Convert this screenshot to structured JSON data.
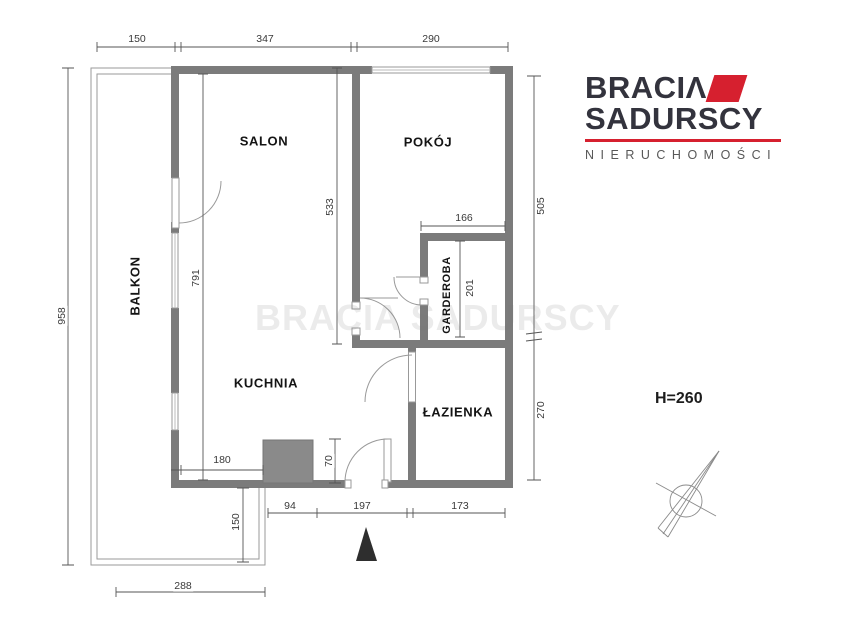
{
  "canvas": {
    "width": 860,
    "height": 628,
    "background": "#ffffff"
  },
  "logo": {
    "line1": "BRACI",
    "line1_glyph": "Λ",
    "line2": "SADURSCY",
    "tagline": "NIERUCHOMOŚCI",
    "accent_color": "#d6202f",
    "text_color": "#33333d"
  },
  "watermark": {
    "text": "BRACIA SADURSCY"
  },
  "height_note": {
    "text": "H=260"
  },
  "plan_colors": {
    "wall": "#7b7b7b",
    "shaft": "#8a8a8a",
    "line": "#999999",
    "dim": "#555555"
  },
  "rooms": [
    {
      "label": "SALON",
      "x": 264,
      "y": 141,
      "rot": 0,
      "small": false
    },
    {
      "label": "POKÓJ",
      "x": 428,
      "y": 142,
      "rot": 0,
      "small": false
    },
    {
      "label": "BALKON",
      "x": 135,
      "y": 286,
      "rot": -90,
      "small": false
    },
    {
      "label": "KUCHNIA",
      "x": 266,
      "y": 383,
      "rot": 0,
      "small": false
    },
    {
      "label": "GARDEROBA",
      "x": 447,
      "y": 295,
      "rot": -90,
      "small": true
    },
    {
      "label": "ŁAZIENKA",
      "x": 458,
      "y": 412,
      "rot": 0,
      "small": false
    }
  ],
  "dimensions": [
    {
      "value": "150",
      "x": 137,
      "y": 39,
      "rot": 0
    },
    {
      "value": "347",
      "x": 265,
      "y": 39,
      "rot": 0
    },
    {
      "value": "290",
      "x": 431,
      "y": 39,
      "rot": 0
    },
    {
      "value": "958",
      "x": 62,
      "y": 316,
      "rot": -90
    },
    {
      "value": "791",
      "x": 196,
      "y": 278,
      "rot": -90
    },
    {
      "value": "533",
      "x": 330,
      "y": 207,
      "rot": -90
    },
    {
      "value": "505",
      "x": 541,
      "y": 206,
      "rot": -90
    },
    {
      "value": "270",
      "x": 541,
      "y": 410,
      "rot": -90
    },
    {
      "value": "166",
      "x": 464,
      "y": 218,
      "rot": 0
    },
    {
      "value": "201",
      "x": 470,
      "y": 288,
      "rot": -90
    },
    {
      "value": "180",
      "x": 222,
      "y": 460,
      "rot": 0
    },
    {
      "value": "70",
      "x": 329,
      "y": 461,
      "rot": -90
    },
    {
      "value": "94",
      "x": 290,
      "y": 506,
      "rot": 0
    },
    {
      "value": "197",
      "x": 362,
      "y": 506,
      "rot": 0
    },
    {
      "value": "173",
      "x": 460,
      "y": 506,
      "rot": 0
    },
    {
      "value": "150",
      "x": 236,
      "y": 522,
      "rot": -90
    },
    {
      "value": "288",
      "x": 183,
      "y": 586,
      "rot": 0
    }
  ]
}
